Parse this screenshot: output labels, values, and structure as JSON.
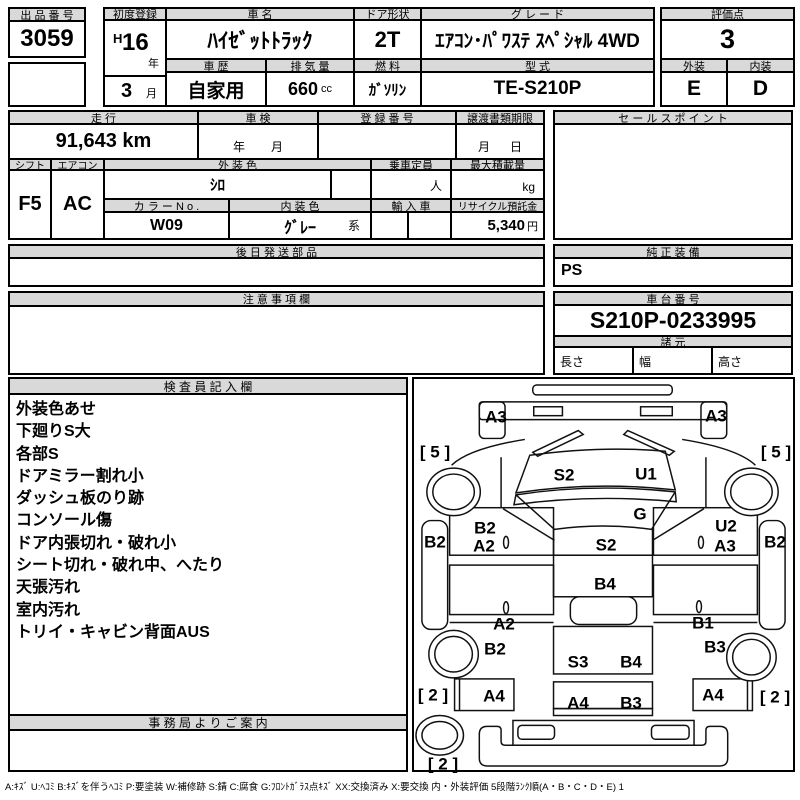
{
  "title_row": {
    "lot_label": "出 品 番 号",
    "lot_value": "3059",
    "first_reg_label": "初度登録",
    "era": "H",
    "reg_year": "16",
    "year_suffix": "年",
    "reg_month": "3",
    "month_suffix": "月",
    "name_label": "車  名",
    "name_value": "ﾊｲｾﾞｯﾄﾄﾗｯｸ",
    "history_label": "車 歴",
    "history_value": "自家用",
    "disp_label": "排 気 量",
    "disp_value": "660",
    "disp_unit": "cc",
    "door_label": "ドア形状",
    "door_value": "2T",
    "fuel_label": "燃 料",
    "fuel_value": "ｶﾞｿﾘﾝ",
    "grade_label": "グ レ ー ド",
    "grade_value": "ｴｱｺﾝ･ﾊﾟﾜｽﾃ ｽﾍﾟｼｬﾙ 4WD",
    "model_label": "型 式",
    "model_value": "TE-S210P",
    "score_label": "評価点",
    "score_value": "3",
    "ext_label": "外装",
    "ext_value": "E",
    "int_label": "内装",
    "int_value": "D"
  },
  "info": {
    "mileage_label": "走 行",
    "mileage_value": "91,643 km",
    "shaken_label": "車 検",
    "shaken_year": "年",
    "shaken_month": "月",
    "regno_label": "登 録 番 号",
    "regno_value": "",
    "deadline_label": "譲渡書類期限",
    "deadline_month": "月",
    "deadline_day": "日",
    "sales_label": "セ ー ル ス ポ イ ン ト",
    "sales_value": "",
    "shift_label": "シフト",
    "shift_value": "F5",
    "ac_label": "エアコン",
    "ac_value": "AC",
    "extcolor_label": "外 装 色",
    "extcolor_value": "ｼﾛ",
    "capacity_label": "乗車定員",
    "capacity_unit": "人",
    "load_label": "最大積載量",
    "load_unit": "kg",
    "colorno_label": "カ ラ ー N o .",
    "colorno_value": "W09",
    "intcolor_label": "内 装 色",
    "intcolor_value": "ｸﾞﾚｰ",
    "intcolor_suffix": "系",
    "import_label": "輸 入 車",
    "recycle_label": "リサイクル預託金",
    "recycle_value": "5,340",
    "recycle_unit": "円"
  },
  "sections": {
    "parts_label": "後 日 発 送 部 品",
    "parts_value": "",
    "equip_label": "純 正 装 備",
    "equip_value": "PS",
    "caution_label": "注 意 事 項 欄",
    "caution_value": "",
    "chassis_label": "車 台 番 号",
    "chassis_value": "S210P-0233995",
    "spec_label": "諸 元",
    "spec_length": "長さ",
    "spec_width": "幅",
    "spec_height": "高さ",
    "inspector_label": "検 査 員 記 入 欄",
    "office_label": "事 務 局 よ り ご 案 内",
    "office_value": ""
  },
  "inspector_notes": [
    "外装色あせ",
    "下廻りS大",
    "各部S",
    "ドアミラー割れ小",
    "ダッシュ板のり跡",
    "コンソール傷",
    "ドア内張切れ・破れ小",
    "シート切れ・破れ中、へたり",
    "天張汚れ",
    "室内汚れ",
    "トリイ・キャビン背面AUS"
  ],
  "diagram_labels": [
    {
      "text": "A3",
      "x": 82,
      "y": 38
    },
    {
      "text": "A3",
      "x": 302,
      "y": 37
    },
    {
      "text": "S2",
      "x": 150,
      "y": 96
    },
    {
      "text": "U1",
      "x": 232,
      "y": 95
    },
    {
      "text": "G",
      "x": 226,
      "y": 135
    },
    {
      "text": "S2",
      "x": 192,
      "y": 166
    },
    {
      "text": "B2",
      "x": 71,
      "y": 149
    },
    {
      "text": "A2",
      "x": 70,
      "y": 167
    },
    {
      "text": "U2",
      "x": 312,
      "y": 147
    },
    {
      "text": "A3",
      "x": 311,
      "y": 167
    },
    {
      "text": "B2",
      "x": 21,
      "y": 163
    },
    {
      "text": "B2",
      "x": 361,
      "y": 163
    },
    {
      "text": "[ 5 ]",
      "x": 21,
      "y": 73
    },
    {
      "text": "[ 5 ]",
      "x": 362,
      "y": 73
    },
    {
      "text": "B4",
      "x": 191,
      "y": 205
    },
    {
      "text": "A2",
      "x": 90,
      "y": 245
    },
    {
      "text": "B1",
      "x": 289,
      "y": 244
    },
    {
      "text": "B2",
      "x": 81,
      "y": 270
    },
    {
      "text": "B3",
      "x": 301,
      "y": 268
    },
    {
      "text": "S3",
      "x": 164,
      "y": 283
    },
    {
      "text": "B4",
      "x": 217,
      "y": 283
    },
    {
      "text": "A4",
      "x": 80,
      "y": 317
    },
    {
      "text": "A4",
      "x": 164,
      "y": 324
    },
    {
      "text": "B3",
      "x": 217,
      "y": 324
    },
    {
      "text": "A4",
      "x": 299,
      "y": 316
    },
    {
      "text": "[ 2 ]",
      "x": 19,
      "y": 316
    },
    {
      "text": "[ 2 ]",
      "x": 361,
      "y": 318
    },
    {
      "text": "[ 2 ]",
      "x": 29,
      "y": 385
    }
  ],
  "footer_legend": "A:ｷｽﾞ  U:ﾍｺﾐ  B:ｷｽﾞを伴うﾍｺﾐ  P:要塗装  W:補修跡  S:錆  C:腐食  G:ﾌﾛﾝﾄｶﾞﾗｽ点ｷｽﾞ  XX:交換済み  X:要交換   内・外装評価  5段階ﾗﾝｸ順(A・B・C・D・E) 1"
}
